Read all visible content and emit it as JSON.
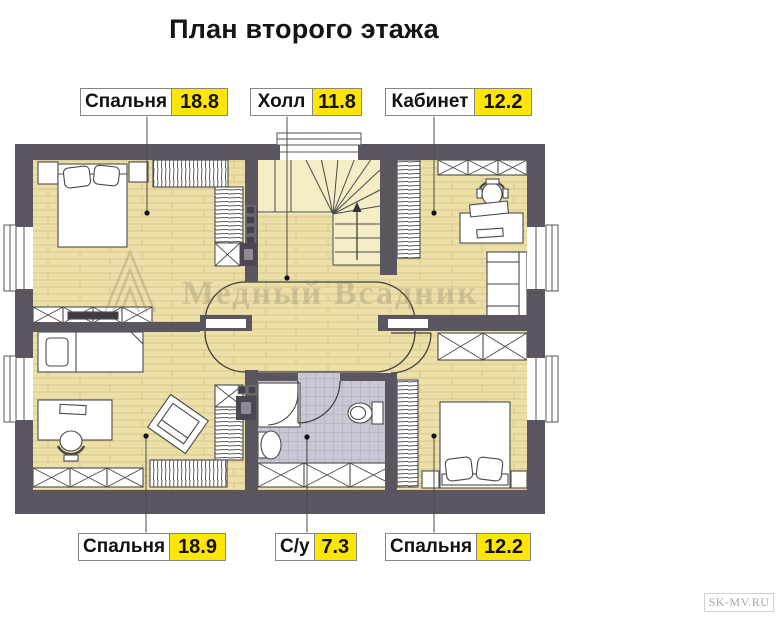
{
  "title": "План второго этажа",
  "rooms": [
    {
      "id": "bedroom-top-left",
      "name": "Спальня",
      "area": "18.8"
    },
    {
      "id": "hall",
      "name": "Холл",
      "area": "11.8"
    },
    {
      "id": "office",
      "name": "Кабинет",
      "area": "12.2"
    },
    {
      "id": "bedroom-bottom-left",
      "name": "Спальня",
      "area": "18.9"
    },
    {
      "id": "bathroom",
      "name": "С/у",
      "area": "7.3"
    },
    {
      "id": "bedroom-bottom-right",
      "name": "Спальня",
      "area": "12.2"
    }
  ],
  "watermark": {
    "text": "Медный Всадник",
    "logo": "gable-roof-logo"
  },
  "site_credit": "SK-MV.RU",
  "colors": {
    "wall": "#5b5560",
    "floor": "#ecdfa7",
    "stairs_floor": "#f4edc5",
    "bathroom_tile": "#c9c7d3",
    "area_badge": "#ffe600",
    "label_border": "#858585"
  }
}
